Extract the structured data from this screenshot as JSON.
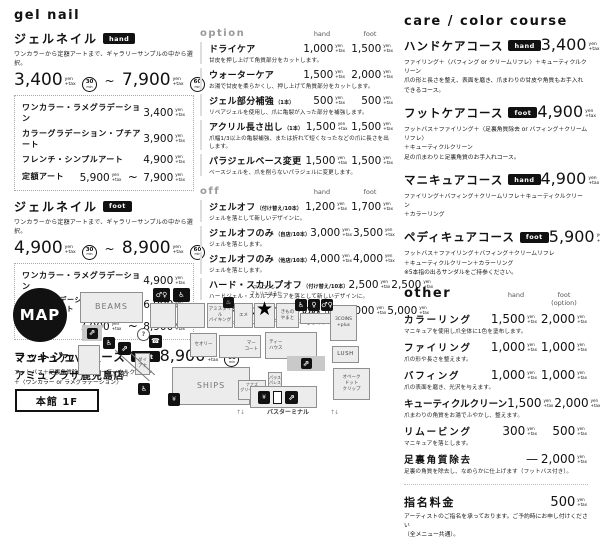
{
  "units": {
    "yen": "yen",
    "tax": "+tax",
    "min": "min",
    "tilde": "~"
  },
  "icons": {
    "restroom": "♂♀",
    "accessible": "♿",
    "escalator": "⇗",
    "info": "?",
    "phone": "☎",
    "atm": "¥",
    "star": "★",
    "female": "♀",
    "spa": "♨",
    "arrows": "↑↓"
  },
  "left": {
    "header": "gel nail",
    "hand": {
      "title": "ジェルネイル",
      "badge": "hand",
      "desc": "ワンカラーから定額アートまで、ギャラリーサンプルの中から選択。",
      "price_from": "3,400",
      "min_from": "30",
      "price_to": "7,900",
      "min_to": "60",
      "rows": [
        {
          "name": "ワンカラー・ラメグラデーション",
          "price": "3,400"
        },
        {
          "name": "カラーグラデーション・プチアート",
          "price": "3,900"
        },
        {
          "name": "フレンチ・シンプルアート",
          "price": "4,900"
        },
        {
          "name": "定額アート",
          "price": "5,900",
          "price2": "7,900"
        }
      ]
    },
    "foot": {
      "title": "ジェルネイル",
      "badge": "foot",
      "desc": "ワンカラーから定額アートまで、ギャラリーサンプルの中から選択。",
      "price_from": "4,900",
      "min_from": "30",
      "price_to": "8,900",
      "min_to": "60",
      "rows": [
        {
          "name": "ワンカラー・ラメグラデーション",
          "price": "4,900"
        },
        {
          "name": "カラーグラデーション・フレンチ\nシンプルアート",
          "price": "6,900"
        },
        {
          "name": "定額アート",
          "price": "7,900",
          "price2": "8,900"
        }
      ]
    },
    "course": {
      "title": "フットジェルコース",
      "badge": "foot",
      "price": "8,900",
      "min": "60",
      "desc": "フットバス＋足裏角質除去＋キューティクルクリーン\n＋〈ワンカラー or ラメグラデーション〉"
    }
  },
  "middle": {
    "option": {
      "header": "option",
      "col_hand": "hand",
      "col_foot": "foot",
      "items": [
        {
          "name": "ドライケア",
          "note": "",
          "hand": "1,000",
          "foot": "1,500",
          "desc": "甘皮を押し上げて角質部分をカットします。"
        },
        {
          "name": "ウォーターケア",
          "note": "",
          "hand": "1,500",
          "foot": "2,000",
          "desc": "お湯で甘皮を柔らかくし、押し上げて角質部分をカットします。"
        },
        {
          "name": "ジェル部分補強",
          "note": "（1本）",
          "hand": "500",
          "foot": "500",
          "desc": "リペアジェルを使用し、爪に亀裂が入った部分を補強します。"
        },
        {
          "name": "アクリル長さ出し",
          "note": "（1本）",
          "hand": "1,500",
          "foot": "1,500",
          "desc": "爪幅1/3以上の亀裂補強、または折れて短くなったなどの爪に長さを出します。"
        },
        {
          "name": "パラジェルベース変更",
          "note": "",
          "hand": "1,500",
          "foot": "1,500",
          "desc": "ベースジェルを、爪を削らないパラジェルに変更します。"
        }
      ]
    },
    "off": {
      "header": "off",
      "col_hand": "hand",
      "col_foot": "foot",
      "items": [
        {
          "name": "ジェルオフ",
          "note": "（付け替え/10本）",
          "hand": "1,200",
          "foot": "1,700",
          "desc": "ジェルを落として新しいデザインに。"
        },
        {
          "name": "ジェルオフのみ",
          "note": "（自店/10本）",
          "hand": "3,000",
          "foot": "3,500",
          "desc": "ジェルを落とします。"
        },
        {
          "name": "ジェルオフのみ",
          "note": "（他店/10本）",
          "hand": "4,000",
          "foot": "4,000",
          "desc": "ジェルを落とします。"
        },
        {
          "name": "ハード・スカルプオフ",
          "note": "（付け替え/10本）",
          "hand": "2,500",
          "foot": "2,500",
          "desc": "ハードジェル・スカルプチュアを落として新しいデザインに。"
        },
        {
          "name": "ハード・スカルプオフのみ",
          "note": "（10本）",
          "hand": "5,000",
          "foot": "5,000",
          "desc": "ハードジェル・スカルプチュアを落とします。"
        }
      ]
    }
  },
  "right": {
    "header": "care / color course",
    "courses": [
      {
        "name": "ハンドケアコース",
        "badge": "hand",
        "price": "3,400",
        "min": "30",
        "desc": "ファイリング＋〈バフィング or クリームリフレ〉＋キューティクルクリーン\n爪の形と長さを整え、表面を磨き、爪まわりの甘皮や角質もお手入れできるコース。"
      },
      {
        "name": "フットケアコース",
        "badge": "foot",
        "price": "4,900",
        "min": "40",
        "desc": "フットバス＋ファイリング＋〈足裏角質除去 or バフィング＋クリームリフレ〉\n＋キューティクルクリーン\n足の爪まわりと足裏角質のお手入れコース。"
      },
      {
        "name": "マニキュアコース",
        "badge": "hand",
        "price": "4,900",
        "min": "50",
        "desc": "ファイリング＋バフィング＋クリームリフレ＋キューティクルクリーン\n＋カラーリング"
      },
      {
        "name": "ペディキュアコース",
        "badge": "foot",
        "price": "5,900",
        "min": "50",
        "desc": "フットバス＋ファイリング＋バフィング＋クリームリフレ\n＋キューティクルクリーン＋カラーリング\n※5本指の出るサンダルをご持参ください。"
      }
    ],
    "other": {
      "header": "other",
      "col_hand": "hand",
      "col_foot": "foot\n(option)",
      "items": [
        {
          "name": "カラーリング",
          "hand": "1,500",
          "foot": "2,000",
          "desc": "マニキュアを使用し爪全体に1色を塗布します。"
        },
        {
          "name": "ファイリング",
          "hand": "1,000",
          "foot": "1,000",
          "desc": "爪の形や長さを整えます。"
        },
        {
          "name": "バフィング",
          "hand": "1,000",
          "foot": "1,000",
          "desc": "爪の表面を磨き、光沢を与えます。"
        },
        {
          "name": "キューティクルクリーン",
          "hand": "1,500",
          "foot": "2,000",
          "desc": "爪まわりの角質をお湯でふやかし、整えます。"
        },
        {
          "name": "リムービング",
          "hand": "300",
          "foot": "500",
          "desc": "マニキュアを落とします。"
        },
        {
          "name": "足裏角質除去",
          "hand": "—",
          "foot": "2,000",
          "desc": "足裏の角質を除去し、なめらかに仕上げます（フットバス付き）。"
        }
      ]
    },
    "nomination": {
      "name": "指名料金",
      "price": "500",
      "desc": "アーティストのご指名を承っております。ご予約時にお申し付けください\n（全メニュー共通）。"
    }
  },
  "map": {
    "circle_label": "MAP",
    "store_name": "マニキュアハウス\nアミュプラザ鹿児島店",
    "floor": "本館 1F",
    "atelier_note": "アイコフレ×\nアトリエはるか",
    "basement": "地下入口",
    "bus_terminal": "バスターミナル",
    "shops": {
      "beams": "BEAMS",
      "amistyle": "アミスタイル\nバイキング",
      "eme": "エメ",
      "kimono": "きもの\nやまと",
      "coins": "3COINS\n+plus",
      "lush": "LUSH",
      "aubake": "オベーク\nドット\nクリップ",
      "theory": "セオリー",
      "mercato": "マー\nコート",
      "teahouse": "ティー\nハウス",
      "ships": "SHIPS",
      "nanas": "ナナズ\nグリーンティー",
      "palace": "パラス\nパレス",
      "diana": "ダイ\nアナ"
    }
  }
}
